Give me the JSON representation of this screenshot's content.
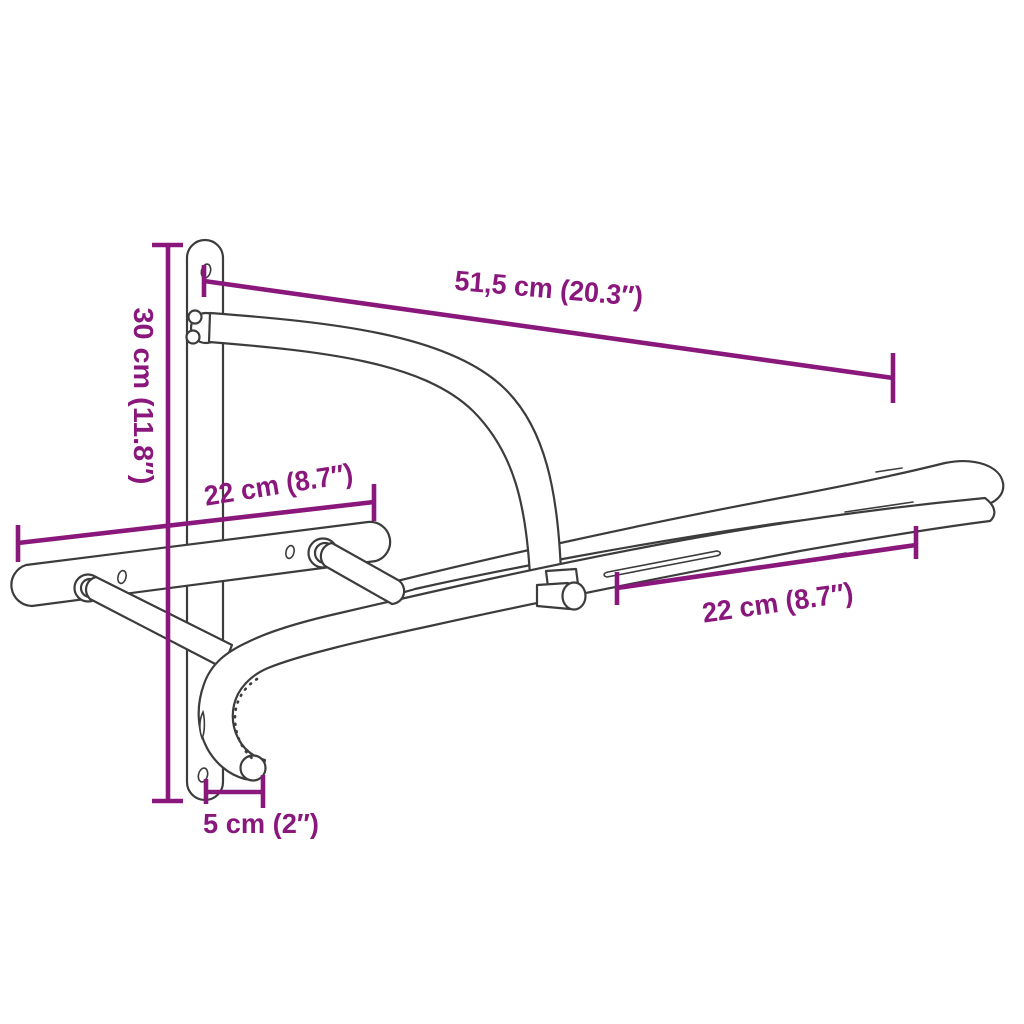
{
  "meta": {
    "description": "Line-drawing dimension diagram of a wall-mounted saddle rack with bridle hook",
    "background": "#ffffff"
  },
  "colors": {
    "dimension": "#8a187c",
    "outline": "#3c3c3c"
  },
  "dimensions": {
    "top_depth": {
      "label": "51,5 cm (20.3″)",
      "value_cm": "51,5",
      "value_in": "20.3"
    },
    "left_height": {
      "label": "30 cm (11.8″)",
      "value_cm": "30",
      "value_in": "11.8"
    },
    "upper_left_rail": {
      "label": "22 cm (8.7″)",
      "value_cm": "22",
      "value_in": "8.7"
    },
    "lower_right_rail": {
      "label": "22 cm (8.7″)",
      "value_cm": "22",
      "value_in": "8.7"
    },
    "bottom_hook": {
      "label": "5 cm (2″)",
      "value_cm": "5",
      "value_in": "2"
    }
  }
}
